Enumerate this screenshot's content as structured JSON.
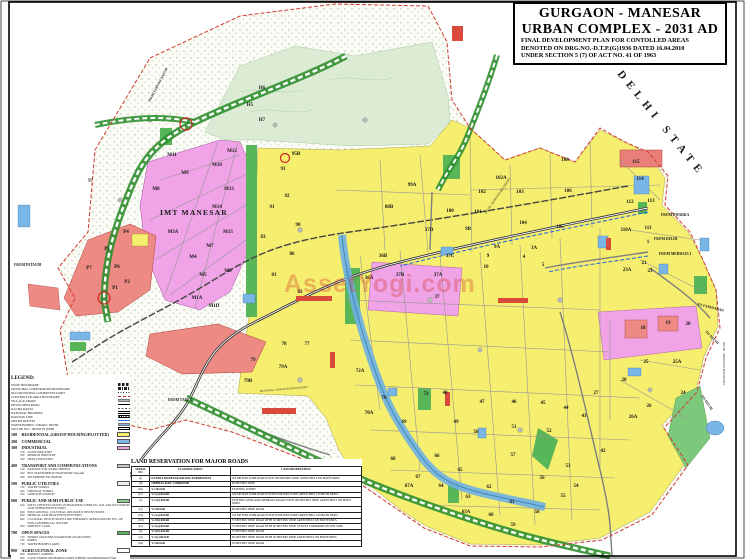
{
  "title_block": {
    "line1": "GURGAON - MANESAR",
    "line2": "URBAN COMPLEX - 2031 AD",
    "sub1": "FINAL DEVELOPMENT PLAN FOR CONTOLLED AREAS",
    "sub2": "DENOTED ON DRG.NO.-D.T.P.(G)1936 DATED 16.04.2010",
    "sub3": "UNDER SECTION 5 (7) OF ACT NO. 41 OF 1963"
  },
  "legend": {
    "heading": "LEGEND:",
    "line_items": [
      {
        "label": "STATE BOUNDARY",
        "sw": "sw-dash"
      },
      {
        "label": "MUNICIPAL CORPORATION BOUNDARY",
        "sw": "sw-dashdot"
      },
      {
        "label": "OLD MUNICIPAL COMMITTEE LIMIT",
        "sw": "sw-dots"
      },
      {
        "label": "CONTROLLED AREA BOUNDARY",
        "sw": "sw-reddash"
      },
      {
        "label": "VILLAGE ABADI",
        "sw": "sw-grey"
      },
      {
        "label": "DEVELOPED ROAD",
        "sw": "sw-road"
      },
      {
        "label": "KACHA RASTA",
        "sw": "sw-kacha"
      },
      {
        "label": "NATIONAL HIGHWAY",
        "sw": "sw-nh"
      },
      {
        "label": "RAILWAY LINE",
        "sw": "sw-rail"
      },
      {
        "label": "METRO ROUTES",
        "sw": "sw-metro"
      },
      {
        "label": "WATER BODIES / DRAIN / RIVER",
        "sw": "sw-water"
      },
      {
        "label": "SECTOR NO. / DENSITY (PPH)",
        "sw": "sw-secbox"
      }
    ],
    "categories": [
      {
        "code": "100",
        "label": "RESIDENTIAL (GROUP HOUSING/PLOTTED)",
        "color": "#f5ee6e",
        "subs": []
      },
      {
        "code": "200",
        "label": "COMMERCIAL",
        "color": "#7db7e8",
        "subs": []
      },
      {
        "code": "300",
        "label": "INDUSTRIAL",
        "color": "#f0a3e6",
        "subs": [
          {
            "code": "310",
            "label": "LIGHT INDUSTRY"
          },
          {
            "code": "320",
            "label": "MEDIUM INDUSTRY"
          },
          {
            "code": "330",
            "label": "HEAVY INDUSTRY"
          }
        ]
      },
      {
        "code": "400",
        "label": "TRANSPORT AND COMMUNICATIONS",
        "color": "#c9c9c9",
        "subs": [
          {
            "code": "410",
            "label": "RAILWAY STN./YARD, SIDINGS"
          },
          {
            "code": "420",
            "label": "BUS STAND/DEPOT/TRANSPORT NAGAR"
          },
          {
            "code": "430",
            "label": "TELEPHONE EXCHANGE"
          }
        ]
      },
      {
        "code": "500",
        "label": "PUBLIC UTILITIES",
        "color": "#efefef",
        "subs": [
          {
            "code": "510",
            "label": "WATER WORKS"
          },
          {
            "code": "520",
            "label": "DISPOSAL WORKS"
          },
          {
            "code": "530",
            "label": "GRID SUB-STATION"
          }
        ]
      },
      {
        "code": "600",
        "label": "PUBLIC AND SEMI PUBLIC USE",
        "color": "#8fd08f",
        "subs": [
          {
            "code": "610",
            "label": "DISTT. OFFICES/COURTS, INTEGRATED COMPLEX, JAIL, POLICE STATION AND OTHER INSTITUTIONS"
          },
          {
            "code": "620",
            "label": "EDUCATIONAL, CULTURAL, RELIGIOUS INSTITUTIONS"
          },
          {
            "code": "630",
            "label": "MEDICAL AND HEALTH INSTITUTIONS"
          },
          {
            "code": "640",
            "label": "CULTURAL INSTITUTIONS LIKE THEATRES, OPERA HOUSES ETC. OF NON-COMMERCIAL NATURE"
          },
          {
            "code": "650",
            "label": "DEFENCE LAND"
          }
        ]
      },
      {
        "code": "700",
        "label": "OPEN SPACES",
        "color": "#58b558",
        "subs": [
          {
            "code": "710",
            "label": "SPORTS GROUNDS/STADIUM/PLAYGROUNDS"
          },
          {
            "code": "720",
            "label": "PARKS"
          },
          {
            "code": "730",
            "label": "WATER BODIES/LAKES"
          }
        ]
      },
      {
        "code": "800",
        "label": "AGRICULTURAL ZONE",
        "color": "#ffffff",
        "subs": [
          {
            "code": "810",
            "label": "MARKET GARDEN"
          },
          {
            "code": "820",
            "label": "LAND UNDER ORCHARDS/CROPS WHERE NO PERMISSION FOR CONSTRUCTION SHALL BE GRANTED"
          }
        ]
      }
    ]
  },
  "road_table": {
    "title": "LAND RESERVATION FOR MAJOR ROADS",
    "headers": [
      "SERIAL NO.",
      "CLASSIFICATION",
      "LAND RESERVATION"
    ],
    "rows": [
      [
        "(i)",
        "KUNDLI-MANESAR-PALWAL EXPRESSWAY",
        "100 METERS WIDE ROAD WITH 100 METERS WIDE GREEN BELT ON BOTH SIDES."
      ],
      [
        "(ii)",
        "ORBITAL RAIL CORRIDOR",
        "90 METERS WIDE"
      ],
      [
        "(iii)",
        "V-1 ROAD",
        "EXISTING WIDTH"
      ],
      [
        "(iv)",
        "V-1 (a) ROAD",
        "100 METERS WIDE ROAD WITH 60 METERS WIDE GREEN BELT ON BOTH SIDES."
      ],
      [
        "(v)",
        "V-1 (b) ROAD",
        "EXISTING GURGAON-MEHRAULI ROAD WITH 100 METERS WIDE GREEN BELT ON BOTH SIDES."
      ],
      [
        "(vi)",
        "V-2 ROAD",
        "60 METERS WIDE ROAD"
      ],
      [
        "(vii)",
        "V-2 (a) ROAD",
        "150 METERS WIDE ROAD WITH 50 METERS WIDE GREEN BELT ON BOTH SIDES."
      ],
      [
        "(viii)",
        "V-2 (b) ROAD",
        "75 METERS WIDE ROAD WITH 30 METERS WIDE GREEN BELT ON BOTH SIDES."
      ],
      [
        "(ix)",
        "V-3 (a) ROAD",
        "75 METERS WIDE ROAD WITH 60 METERS WIDE UTILITY CORRIDOR ON ONE SIDE."
      ],
      [
        "(x)",
        "V-3 (b) ROAD",
        "75 METERS WIDE ROAD"
      ],
      [
        "(xi)",
        "V-3 (c) ROAD",
        "90 METERS WIDE ROAD WITH 30 METERS WIDE GREEN BELT ON BOTH SIDES."
      ],
      [
        "(xii)",
        "V-3 ROAD",
        "30 METERS WIDE ROAD"
      ]
    ]
  },
  "map": {
    "watermark": "AssetYogi.com",
    "colors": {
      "residential_yellow": "#f5ee6e",
      "industrial_pink": "#f0a3e6",
      "commercial_blue": "#7db7e8",
      "open_space_green": "#58b558",
      "zone_red": "#ed8a84",
      "boundary_red": "#d23b2f",
      "transport_grey": "#c9c9c9"
    },
    "edge_labels": [
      {
        "t": "DELHI STATE",
        "x": 617,
        "y": 74,
        "r": 51,
        "s": 11,
        "ls": 5.5,
        "b": 1,
        "n": "delhi-state-label"
      },
      {
        "t": "FROM DWARKA",
        "x": 661,
        "y": 216,
        "s": 3.6,
        "b": 1,
        "n": "from-dwarka-label"
      },
      {
        "t": "FROM DELHI",
        "x": 654,
        "y": 240,
        "s": 3.6,
        "b": 1,
        "n": "from-delhi-label"
      },
      {
        "t": "FROM MEHRAULI",
        "x": 659,
        "y": 255,
        "s": 3.6,
        "b": 1,
        "n": "from-mehrauli-label"
      },
      {
        "t": "TO FARIDABAD",
        "x": 697,
        "y": 305,
        "r": 14,
        "s": 3.6,
        "b": 1,
        "n": "to-faridabad-label"
      },
      {
        "t": "TO DELHI",
        "x": 705,
        "y": 332,
        "r": 45,
        "s": 3.6,
        "b": 1,
        "n": "to-delhi-label"
      },
      {
        "t": "TO DELHI",
        "x": 701,
        "y": 396,
        "r": 55,
        "s": 3.6,
        "b": 1,
        "n": "to-delhi-label-2"
      },
      {
        "t": "FROM PATAUDI",
        "x": 14,
        "y": 266,
        "s": 3.6,
        "b": 1,
        "n": "from-pataudi-label"
      },
      {
        "t": "FROM TAURU",
        "x": 168,
        "y": 401,
        "s": 3.6,
        "b": 1,
        "n": "from-tauru-label"
      },
      {
        "t": "FROM FARUKH NAGAR",
        "x": 150,
        "y": 102,
        "r": -62,
        "s": 3.3,
        "b": 1,
        "n": "from-farukh-nagar-label"
      },
      {
        "t": "DELHI - HARYANA BOUNDARY",
        "x": 486,
        "y": 214,
        "r": -55,
        "s": 3,
        "b": 0,
        "n": "delhi-haryana-boundary-label"
      },
      {
        "t": "DELHI - HARYANA BOUNDARY",
        "x": 723,
        "y": 342,
        "r": 90,
        "s": 3,
        "b": 0,
        "n": "delhi-haryana-boundary-label-2"
      },
      {
        "t": "IMT MANESAR",
        "x": 160,
        "y": 215,
        "s": 7.5,
        "ls": 1.2,
        "b": 1,
        "n": "imt-manesar-label"
      },
      {
        "t": "MUNICIPAL CORPORATION BOUNDARY",
        "x": 260,
        "y": 392,
        "r": -5,
        "s": 2.6,
        "b": 0,
        "n": "municipal-corporation-boundary-label"
      }
    ],
    "sector_labels": [
      {
        "t": "M11",
        "x": 172,
        "y": 156
      },
      {
        "t": "M12",
        "x": 232,
        "y": 152
      },
      {
        "t": "M10",
        "x": 217,
        "y": 166
      },
      {
        "t": "M9",
        "x": 185,
        "y": 174
      },
      {
        "t": "M8",
        "x": 156,
        "y": 190
      },
      {
        "t": "M13",
        "x": 229,
        "y": 190
      },
      {
        "t": "M14",
        "x": 217,
        "y": 208
      },
      {
        "t": "M3A",
        "x": 173,
        "y": 233
      },
      {
        "t": "M15",
        "x": 228,
        "y": 233
      },
      {
        "t": "M7",
        "x": 210,
        "y": 247
      },
      {
        "t": "M4",
        "x": 193,
        "y": 258
      },
      {
        "t": "M6",
        "x": 228,
        "y": 272
      },
      {
        "t": "M5",
        "x": 203,
        "y": 276
      },
      {
        "t": "M1A",
        "x": 197,
        "y": 299
      },
      {
        "t": "M1D",
        "x": 214,
        "y": 307
      },
      {
        "t": "H6",
        "x": 262,
        "y": 89
      },
      {
        "t": "H5",
        "x": 250,
        "y": 106
      },
      {
        "t": "H7",
        "x": 262,
        "y": 121
      },
      {
        "t": "P4",
        "x": 126,
        "y": 233
      },
      {
        "t": "P5",
        "x": 107,
        "y": 250
      },
      {
        "t": "P6",
        "x": 117,
        "y": 268
      },
      {
        "t": "P7",
        "x": 89,
        "y": 269
      },
      {
        "t": "P2",
        "x": 127,
        "y": 283
      },
      {
        "t": "P1",
        "x": 115,
        "y": 289
      },
      {
        "t": "95B",
        "x": 296,
        "y": 155
      },
      {
        "t": "93",
        "x": 283,
        "y": 170
      },
      {
        "t": "92",
        "x": 287,
        "y": 197
      },
      {
        "t": "91",
        "x": 272,
        "y": 208
      },
      {
        "t": "90",
        "x": 298,
        "y": 226
      },
      {
        "t": "83",
        "x": 263,
        "y": 238
      },
      {
        "t": "86",
        "x": 292,
        "y": 255
      },
      {
        "t": "81",
        "x": 274,
        "y": 276
      },
      {
        "t": "82",
        "x": 300,
        "y": 293
      },
      {
        "t": "77",
        "x": 307,
        "y": 345
      },
      {
        "t": "78",
        "x": 284,
        "y": 345
      },
      {
        "t": "79",
        "x": 253,
        "y": 361
      },
      {
        "t": "79A",
        "x": 283,
        "y": 368
      },
      {
        "t": "79B",
        "x": 248,
        "y": 382
      },
      {
        "t": "99A",
        "x": 412,
        "y": 186
      },
      {
        "t": "102A",
        "x": 501,
        "y": 179
      },
      {
        "t": "102",
        "x": 482,
        "y": 193
      },
      {
        "t": "103",
        "x": 520,
        "y": 193
      },
      {
        "t": "108",
        "x": 565,
        "y": 161
      },
      {
        "t": "106",
        "x": 568,
        "y": 192
      },
      {
        "t": "88B",
        "x": 389,
        "y": 208
      },
      {
        "t": "100",
        "x": 450,
        "y": 212
      },
      {
        "t": "101",
        "x": 478,
        "y": 213
      },
      {
        "t": "104",
        "x": 523,
        "y": 224
      },
      {
        "t": "105",
        "x": 560,
        "y": 228
      },
      {
        "t": "110A",
        "x": 626,
        "y": 231
      },
      {
        "t": "111",
        "x": 648,
        "y": 229
      },
      {
        "t": "112",
        "x": 630,
        "y": 203
      },
      {
        "t": "113",
        "x": 651,
        "y": 202
      },
      {
        "t": "114",
        "x": 640,
        "y": 180
      },
      {
        "t": "115",
        "x": 636,
        "y": 163
      },
      {
        "t": "1",
        "x": 648,
        "y": 243
      },
      {
        "t": "21",
        "x": 644,
        "y": 264
      },
      {
        "t": "23",
        "x": 650,
        "y": 272
      },
      {
        "t": "23A",
        "x": 627,
        "y": 271
      },
      {
        "t": "37D",
        "x": 429,
        "y": 231
      },
      {
        "t": "9B",
        "x": 468,
        "y": 230
      },
      {
        "t": "9A",
        "x": 497,
        "y": 248
      },
      {
        "t": "3A",
        "x": 534,
        "y": 249
      },
      {
        "t": "37C",
        "x": 450,
        "y": 257
      },
      {
        "t": "9",
        "x": 488,
        "y": 257
      },
      {
        "t": "10",
        "x": 486,
        "y": 268
      },
      {
        "t": "37A",
        "x": 438,
        "y": 276
      },
      {
        "t": "37B",
        "x": 400,
        "y": 276
      },
      {
        "t": "36B",
        "x": 383,
        "y": 257
      },
      {
        "t": "36A",
        "x": 369,
        "y": 279
      },
      {
        "t": "37",
        "x": 437,
        "y": 298
      },
      {
        "t": "4",
        "x": 524,
        "y": 258
      },
      {
        "t": "5",
        "x": 543,
        "y": 266
      },
      {
        "t": "18",
        "x": 643,
        "y": 329
      },
      {
        "t": "19",
        "x": 668,
        "y": 324
      },
      {
        "t": "20",
        "x": 688,
        "y": 325
      },
      {
        "t": "25",
        "x": 646,
        "y": 363
      },
      {
        "t": "25A",
        "x": 677,
        "y": 363
      },
      {
        "t": "28",
        "x": 624,
        "y": 381
      },
      {
        "t": "24",
        "x": 683,
        "y": 394
      },
      {
        "t": "26",
        "x": 649,
        "y": 407
      },
      {
        "t": "26A",
        "x": 633,
        "y": 418
      },
      {
        "t": "27",
        "x": 596,
        "y": 394
      },
      {
        "t": "42",
        "x": 603,
        "y": 452
      },
      {
        "t": "43",
        "x": 584,
        "y": 417
      },
      {
        "t": "44",
        "x": 566,
        "y": 409
      },
      {
        "t": "45",
        "x": 543,
        "y": 404
      },
      {
        "t": "46",
        "x": 514,
        "y": 403
      },
      {
        "t": "47",
        "x": 482,
        "y": 403
      },
      {
        "t": "48",
        "x": 445,
        "y": 394
      },
      {
        "t": "49",
        "x": 456,
        "y": 423
      },
      {
        "t": "50",
        "x": 476,
        "y": 433
      },
      {
        "t": "51",
        "x": 514,
        "y": 428
      },
      {
        "t": "52",
        "x": 549,
        "y": 432
      },
      {
        "t": "53",
        "x": 568,
        "y": 467
      },
      {
        "t": "54",
        "x": 576,
        "y": 487
      },
      {
        "t": "55",
        "x": 563,
        "y": 497
      },
      {
        "t": "56",
        "x": 542,
        "y": 479
      },
      {
        "t": "57",
        "x": 513,
        "y": 456
      },
      {
        "t": "58",
        "x": 537,
        "y": 513
      },
      {
        "t": "59",
        "x": 513,
        "y": 526
      },
      {
        "t": "60",
        "x": 491,
        "y": 516
      },
      {
        "t": "61",
        "x": 512,
        "y": 503
      },
      {
        "t": "62",
        "x": 489,
        "y": 488
      },
      {
        "t": "63",
        "x": 468,
        "y": 498
      },
      {
        "t": "63A",
        "x": 466,
        "y": 513
      },
      {
        "t": "64",
        "x": 441,
        "y": 487
      },
      {
        "t": "65",
        "x": 460,
        "y": 471
      },
      {
        "t": "66",
        "x": 437,
        "y": 457
      },
      {
        "t": "67",
        "x": 418,
        "y": 478
      },
      {
        "t": "67A",
        "x": 409,
        "y": 487
      },
      {
        "t": "68",
        "x": 393,
        "y": 460
      },
      {
        "t": "69",
        "x": 404,
        "y": 423
      },
      {
        "t": "70",
        "x": 384,
        "y": 399
      },
      {
        "t": "70A",
        "x": 369,
        "y": 414
      },
      {
        "t": "72A",
        "x": 360,
        "y": 372
      },
      {
        "t": "73",
        "x": 426,
        "y": 395
      }
    ]
  }
}
